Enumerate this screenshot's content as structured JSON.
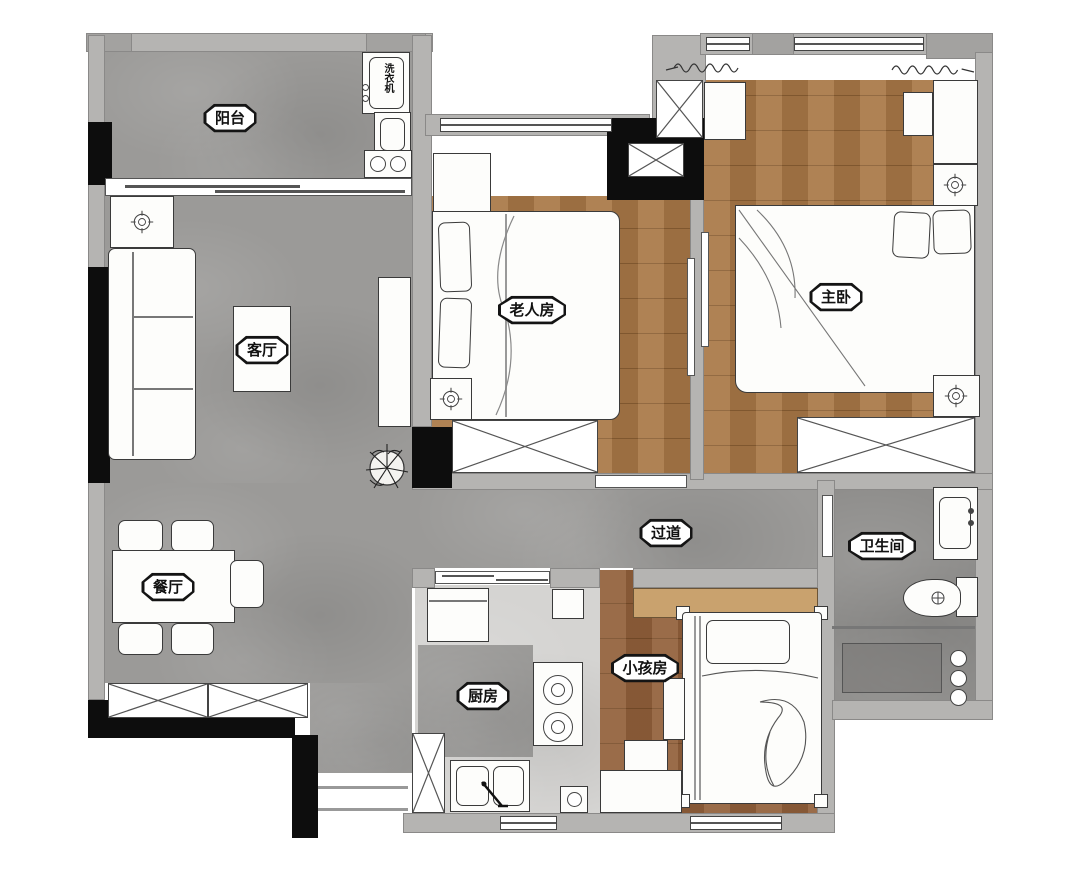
{
  "meta": {
    "kind": "residential-floor-plan"
  },
  "rooms": {
    "balcony": {
      "label": "阳台"
    },
    "living": {
      "label": "客厅"
    },
    "dining": {
      "label": "餐厅"
    },
    "elder": {
      "label": "老人房"
    },
    "master": {
      "label": "主卧"
    },
    "hallway": {
      "label": "过道"
    },
    "bath": {
      "label": "卫生间"
    },
    "kitchen": {
      "label": "厨房"
    },
    "kids": {
      "label": "小孩房"
    }
  },
  "appliances": {
    "washer": {
      "label": "洗衣机"
    }
  },
  "colors": {
    "wall": "#b5b4b2",
    "wall_black": "#0d0d0d",
    "floor_gray": "#9b9a98",
    "wood": "#a87746",
    "wood_dark": "#91603a",
    "wardrobe_tan": "#c9a26e"
  }
}
